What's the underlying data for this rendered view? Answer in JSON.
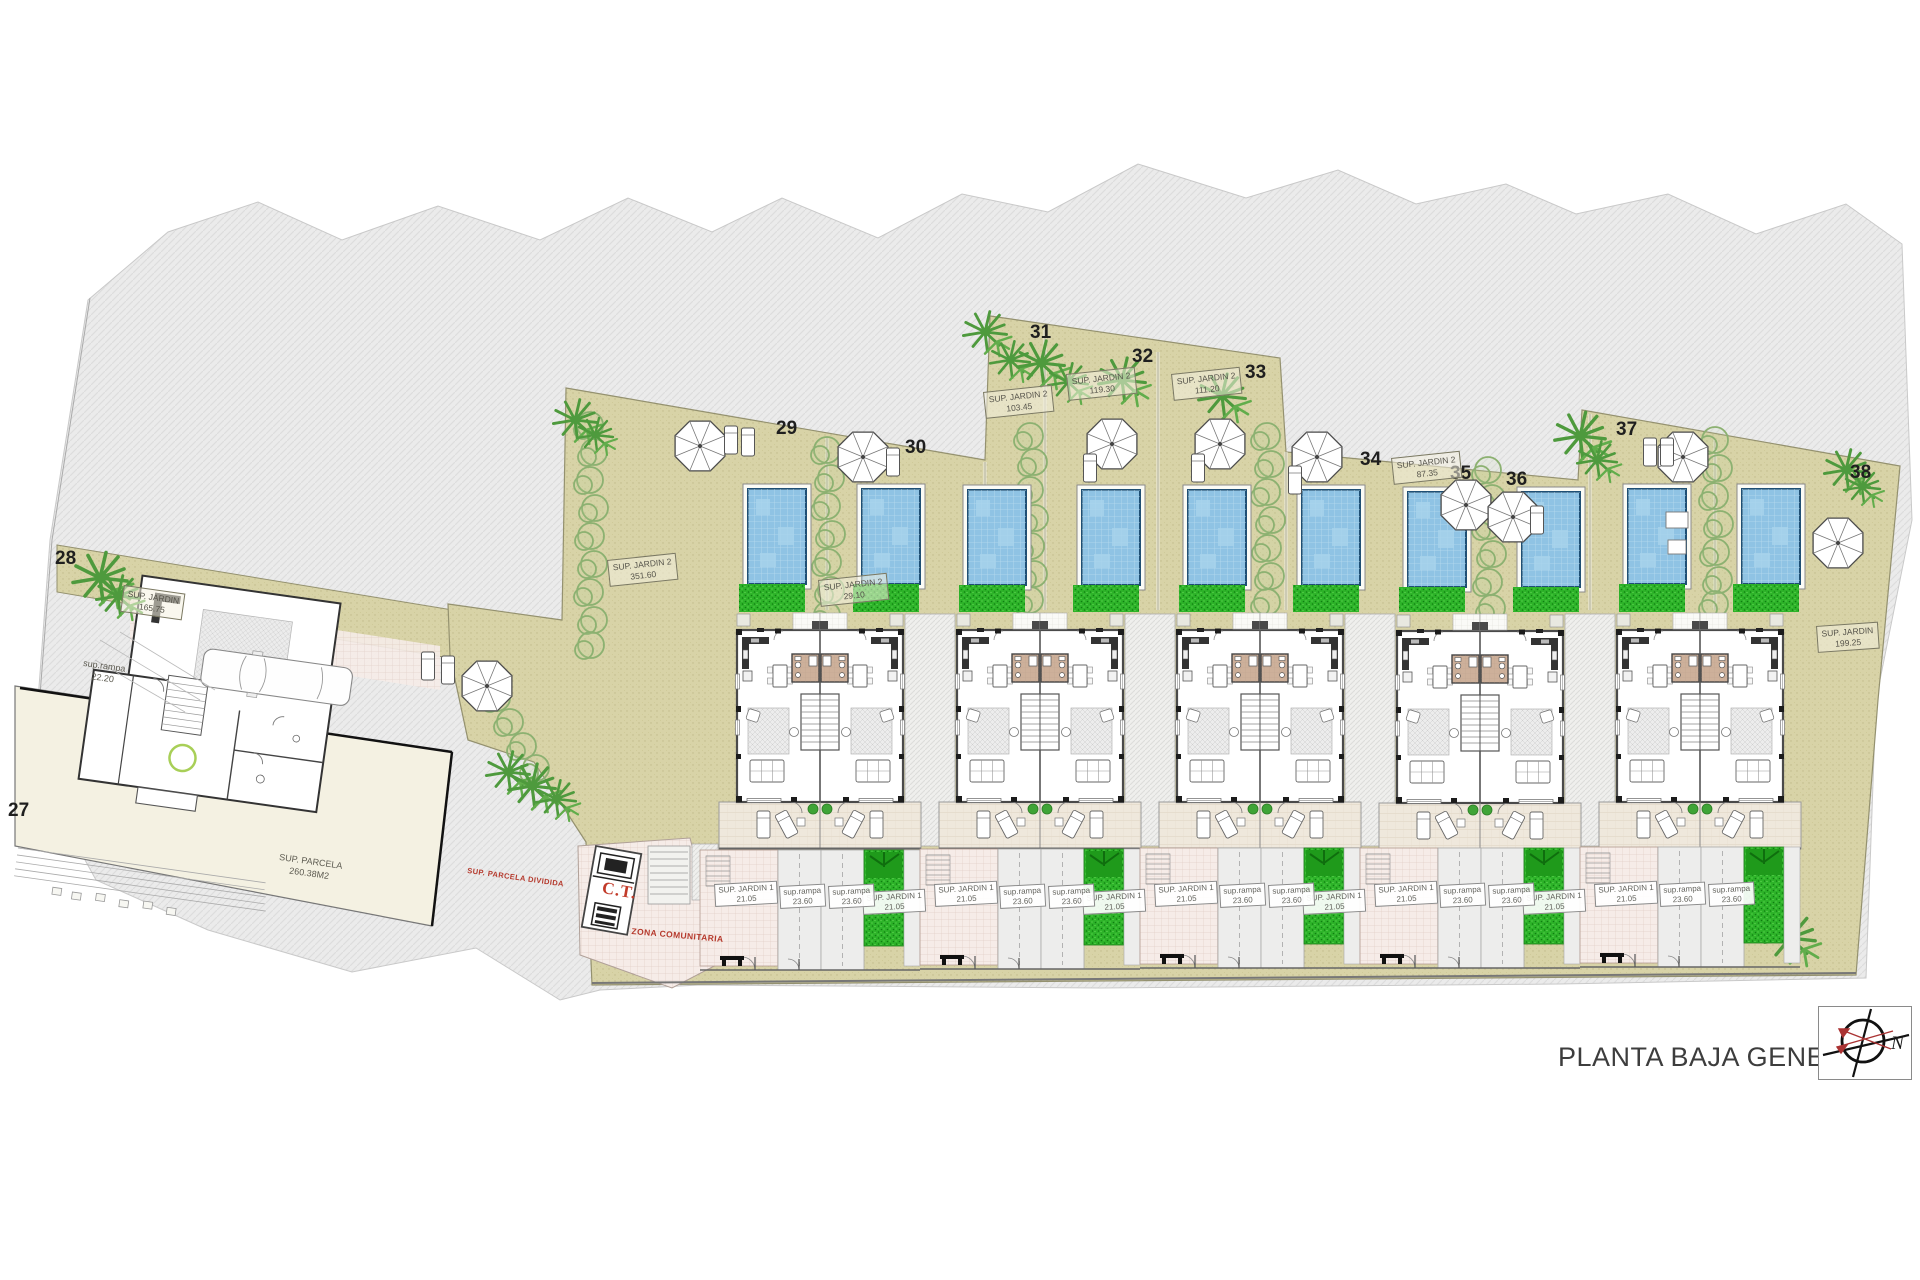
{
  "title": "PLANTA BAJA GENERAL",
  "compass": {
    "north": "N"
  },
  "plot_numbers": {
    "p27": "27",
    "p28": "28",
    "p29": "29",
    "p30": "30",
    "p31": "31",
    "p32": "32",
    "p33": "33",
    "p34": "34",
    "p35": "35",
    "p36": "36",
    "p37": "37",
    "p38": "38"
  },
  "labels": {
    "jardin28": {
      "line1": "SUP. JARDIN",
      "line2": "165.75"
    },
    "jardin29": {
      "line1": "SUP. JARDIN 2",
      "line2": "351.60"
    },
    "jardin30": {
      "line1": "SUP. JARDIN 2",
      "line2": "29.10"
    },
    "jardin31": {
      "line1": "SUP. JARDIN 2",
      "line2": "103.45"
    },
    "jardin32": {
      "line1": "SUP. JARDIN 2",
      "line2": "119.30"
    },
    "jardin33": {
      "line1": "SUP. JARDIN 2",
      "line2": "111.20"
    },
    "jardin34": {
      "line1": "SUP. JARDIN 2",
      "line2": "87.35"
    },
    "jardin38": {
      "line1": "SUP. JARDIN",
      "line2": "199.25"
    },
    "jardin1_strip": {
      "line1": "SUP. JARDIN 1",
      "line2": "21.05"
    },
    "rampa": {
      "line1": "sup.rampa",
      "line2": "23.60"
    },
    "rampa27": {
      "line1": "sup.rampa",
      "line2": "22.20"
    },
    "parcela27": {
      "line1": "SUP. PARCELA",
      "line2": "260.38M2"
    },
    "ct": "C.T.",
    "parcela_dividida": "SUP. PARCELA DIVIDIDA",
    "zona_comunitaria": "ZONA COMUNITARIA"
  }
}
